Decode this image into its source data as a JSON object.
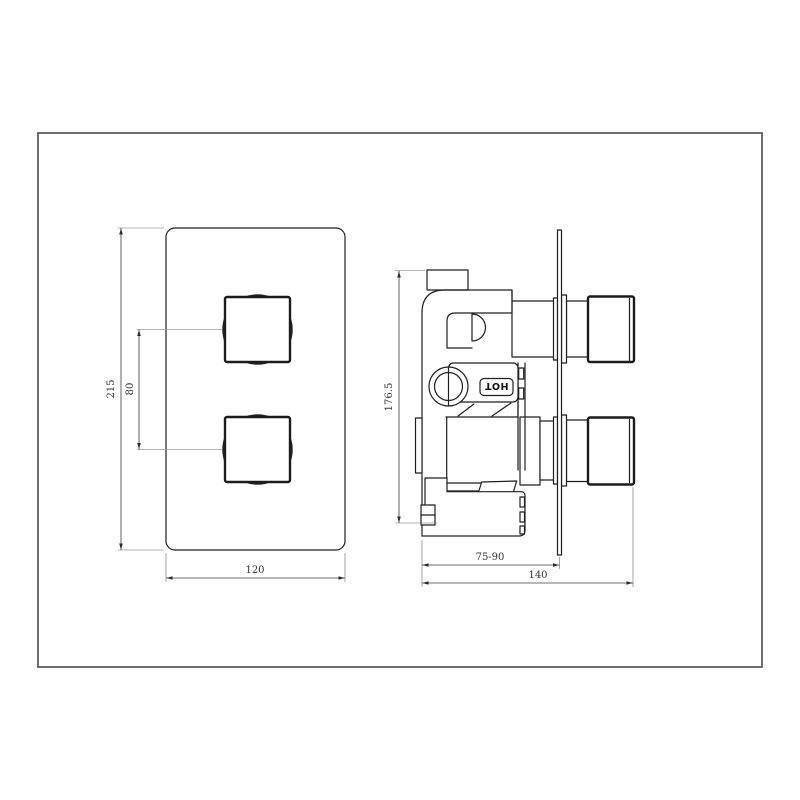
{
  "page": {
    "background": "#ffffff",
    "border_color": "#5f5f5f",
    "line_color": "#1f1f1f",
    "dim_color": "#3c3c3c"
  },
  "drawing": {
    "type": "technical-drawing",
    "subject": "concealed twin thermostatic shower valve - front elevation and side elevation"
  },
  "dims": {
    "front_height": "215",
    "handle_spacing": "80",
    "front_width": "120",
    "side_height": "176.5",
    "depth_range": "75-90",
    "total_depth": "140"
  },
  "labels": {
    "hot": "HOT"
  }
}
